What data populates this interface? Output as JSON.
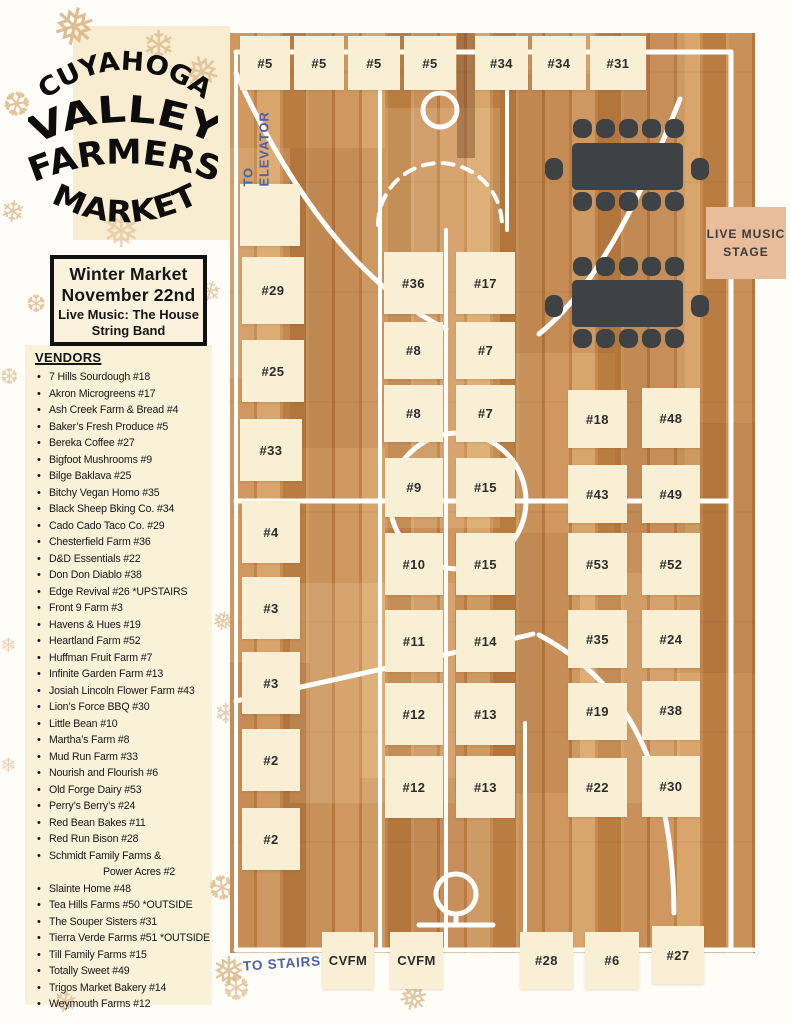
{
  "sidebar": {
    "logo": {
      "lines": [
        "CUYAHOGA",
        "VALLEY",
        "FARMERS",
        "MARKET"
      ]
    },
    "event_box": {
      "line1": "Winter Market",
      "line2": "November 22nd",
      "line3": "Live Music: The House String Band"
    },
    "vendors_heading": "VENDORS",
    "vendors": [
      {
        "text": "7 Hills Sourdough #18"
      },
      {
        "text": "Akron Microgreens #17"
      },
      {
        "text": "Ash Creek Farm & Bread #4"
      },
      {
        "text": "Baker’s Fresh Produce  #5"
      },
      {
        "text": "Bereka Coffee #27"
      },
      {
        "text": "Bigfoot Mushrooms  #9"
      },
      {
        "text": "Bilge Baklava #25"
      },
      {
        "text": "Bitchy Vegan Homo #35"
      },
      {
        "text": "Black Sheep Bking Co. #34"
      },
      {
        "text": "Cado Cado Taco Co. #29"
      },
      {
        "text": "Chesterfield Farm #36"
      },
      {
        "text": "D&D Essentials #22"
      },
      {
        "text": "Don Don Diablo #38"
      },
      {
        "text": "Edge Revival #26 *UPSTAIRS"
      },
      {
        "text": "Front 9 Farm #3"
      },
      {
        "text": "Havens & Hues #19"
      },
      {
        "text": "Heartland Farm #52"
      },
      {
        "text": "Huffman Fruit Farm #7"
      },
      {
        "text": "Infinite Garden Farm #13"
      },
      {
        "text": "Josiah Lincoln Flower Farm #43"
      },
      {
        "text": "Lion’s Force BBQ #30"
      },
      {
        "text": "Little Bean #10"
      },
      {
        "text": "Martha’s Farm  #8"
      },
      {
        "text": "Mud Run Farm #33"
      },
      {
        "text": "Nourish and Flourish  #6"
      },
      {
        "text": "Old Forge Dairy #53"
      },
      {
        "text": "Perry’s Berry’s  #24"
      },
      {
        "text": "Red Bean Bakes  #11"
      },
      {
        "text": "Red Run Bison #28"
      },
      {
        "text": "Schmidt Family Farms &"
      },
      {
        "text": "Power Acres #2",
        "indent": true
      },
      {
        "text": "Slainte Home #48"
      },
      {
        "text": "Tea Hills Farms #50 *OUTSIDE"
      },
      {
        "text": "The Souper Sisters #31"
      },
      {
        "text": "Tierra Verde Farms #51 *OUTSIDE"
      },
      {
        "text": "Till Family Farms #15"
      },
      {
        "text": "Totally Sweet #49"
      },
      {
        "text": "Trigos Market Bakery #14"
      },
      {
        "text": "Weymouth Farms #12"
      }
    ]
  },
  "map": {
    "to_elevator": "TO ELEVATOR",
    "to_stairs": "TO STAIRS",
    "stage": {
      "label": "LIVE MUSIC STAGE"
    },
    "booths": [
      {
        "label": "#5",
        "x": 240,
        "y": 36,
        "w": 50,
        "h": 54
      },
      {
        "label": "#5",
        "x": 294,
        "y": 36,
        "w": 50,
        "h": 54
      },
      {
        "label": "#5",
        "x": 348,
        "y": 36,
        "w": 52,
        "h": 54
      },
      {
        "label": "#5",
        "x": 404,
        "y": 36,
        "w": 52,
        "h": 54
      },
      {
        "label": "#34",
        "x": 475,
        "y": 36,
        "w": 53,
        "h": 54
      },
      {
        "label": "#34",
        "x": 532,
        "y": 36,
        "w": 54,
        "h": 54
      },
      {
        "label": "#31",
        "x": 590,
        "y": 36,
        "w": 56,
        "h": 54
      },
      {
        "label": "",
        "x": 240,
        "y": 184,
        "w": 60,
        "h": 62
      },
      {
        "label": "#29",
        "x": 242,
        "y": 257,
        "w": 62,
        "h": 67
      },
      {
        "label": "#25",
        "x": 242,
        "y": 340,
        "w": 62,
        "h": 62
      },
      {
        "label": "#33",
        "x": 240,
        "y": 419,
        "w": 62,
        "h": 62
      },
      {
        "label": "#4",
        "x": 242,
        "y": 501,
        "w": 58,
        "h": 62
      },
      {
        "label": "#3",
        "x": 242,
        "y": 577,
        "w": 58,
        "h": 62
      },
      {
        "label": "#3",
        "x": 242,
        "y": 652,
        "w": 58,
        "h": 62
      },
      {
        "label": "#2",
        "x": 242,
        "y": 729,
        "w": 58,
        "h": 62
      },
      {
        "label": "#2",
        "x": 242,
        "y": 808,
        "w": 58,
        "h": 62
      },
      {
        "label": "#36",
        "x": 384,
        "y": 252,
        "w": 59,
        "h": 62
      },
      {
        "label": "#17",
        "x": 456,
        "y": 252,
        "w": 59,
        "h": 62
      },
      {
        "label": "#8",
        "x": 384,
        "y": 322,
        "w": 59,
        "h": 57
      },
      {
        "label": "#7",
        "x": 456,
        "y": 322,
        "w": 59,
        "h": 57
      },
      {
        "label": "#8",
        "x": 384,
        "y": 385,
        "w": 59,
        "h": 57
      },
      {
        "label": "#7",
        "x": 456,
        "y": 385,
        "w": 59,
        "h": 57
      },
      {
        "label": "#9",
        "x": 385,
        "y": 458,
        "w": 58,
        "h": 59
      },
      {
        "label": "#15",
        "x": 456,
        "y": 458,
        "w": 59,
        "h": 59
      },
      {
        "label": "#10",
        "x": 385,
        "y": 533,
        "w": 58,
        "h": 62
      },
      {
        "label": "#15",
        "x": 456,
        "y": 533,
        "w": 59,
        "h": 62
      },
      {
        "label": "#11",
        "x": 385,
        "y": 610,
        "w": 58,
        "h": 62
      },
      {
        "label": "#14",
        "x": 456,
        "y": 610,
        "w": 59,
        "h": 62
      },
      {
        "label": "#12",
        "x": 385,
        "y": 683,
        "w": 58,
        "h": 62
      },
      {
        "label": "#13",
        "x": 456,
        "y": 683,
        "w": 59,
        "h": 62
      },
      {
        "label": "#12",
        "x": 385,
        "y": 756,
        "w": 58,
        "h": 62
      },
      {
        "label": "#13",
        "x": 456,
        "y": 756,
        "w": 59,
        "h": 62
      },
      {
        "label": "#18",
        "x": 568,
        "y": 390,
        "w": 59,
        "h": 58
      },
      {
        "label": "#48",
        "x": 642,
        "y": 388,
        "w": 58,
        "h": 60
      },
      {
        "label": "#43",
        "x": 568,
        "y": 465,
        "w": 59,
        "h": 58
      },
      {
        "label": "#49",
        "x": 642,
        "y": 465,
        "w": 58,
        "h": 58
      },
      {
        "label": "#53",
        "x": 568,
        "y": 533,
        "w": 59,
        "h": 62
      },
      {
        "label": "#52",
        "x": 642,
        "y": 533,
        "w": 58,
        "h": 62
      },
      {
        "label": "#35",
        "x": 568,
        "y": 610,
        "w": 59,
        "h": 58
      },
      {
        "label": "#24",
        "x": 642,
        "y": 610,
        "w": 58,
        "h": 58
      },
      {
        "label": "#19",
        "x": 568,
        "y": 683,
        "w": 59,
        "h": 57
      },
      {
        "label": "#38",
        "x": 642,
        "y": 681,
        "w": 58,
        "h": 59
      },
      {
        "label": "#22",
        "x": 568,
        "y": 758,
        "w": 59,
        "h": 59
      },
      {
        "label": "#30",
        "x": 642,
        "y": 756,
        "w": 58,
        "h": 61
      },
      {
        "label": "CVFM",
        "x": 322,
        "y": 932,
        "w": 52,
        "h": 57
      },
      {
        "label": "CVFM",
        "x": 390,
        "y": 932,
        "w": 53,
        "h": 57
      },
      {
        "label": "#28",
        "x": 520,
        "y": 932,
        "w": 53,
        "h": 57
      },
      {
        "label": "#6",
        "x": 585,
        "y": 932,
        "w": 54,
        "h": 57
      },
      {
        "label": "#27",
        "x": 652,
        "y": 926,
        "w": 52,
        "h": 58
      }
    ]
  },
  "decor": {
    "snowflakes": [
      {
        "g": "❅",
        "x": 52,
        "y": 2,
        "s": 52,
        "o": 0.95,
        "r": 12
      },
      {
        "g": "❄",
        "x": 142,
        "y": 26,
        "s": 40,
        "o": 0.8,
        "r": 0
      },
      {
        "g": "❆",
        "x": 2,
        "y": 88,
        "s": 34,
        "o": 0.85,
        "r": 20
      },
      {
        "g": "❅",
        "x": 184,
        "y": 52,
        "s": 44,
        "o": 0.75,
        "r": -14
      },
      {
        "g": "❄",
        "x": 0,
        "y": 198,
        "s": 30,
        "o": 0.8,
        "r": 8
      },
      {
        "g": "❅",
        "x": 102,
        "y": 208,
        "s": 46,
        "o": 0.55,
        "r": 0
      },
      {
        "g": "❆",
        "x": 26,
        "y": 293,
        "s": 24,
        "o": 0.8,
        "r": 0
      },
      {
        "g": "❄",
        "x": 198,
        "y": 278,
        "s": 28,
        "o": 0.7,
        "r": 16
      },
      {
        "g": "❆",
        "x": 0,
        "y": 366,
        "s": 22,
        "o": 0.7,
        "r": 0
      },
      {
        "g": "❅",
        "x": 212,
        "y": 608,
        "s": 26,
        "o": 0.75,
        "r": 10
      },
      {
        "g": "❄",
        "x": 214,
        "y": 700,
        "s": 28,
        "o": 0.7,
        "r": 0
      },
      {
        "g": "❆",
        "x": 208,
        "y": 872,
        "s": 34,
        "o": 0.8,
        "r": -10
      },
      {
        "g": "❅",
        "x": 212,
        "y": 952,
        "s": 40,
        "o": 0.85,
        "r": 0
      },
      {
        "g": "❄",
        "x": 52,
        "y": 988,
        "s": 30,
        "o": 0.75,
        "r": 12
      },
      {
        "g": "❆",
        "x": 222,
        "y": 972,
        "s": 34,
        "o": 0.7,
        "r": 0
      },
      {
        "g": "❅",
        "x": 398,
        "y": 980,
        "s": 36,
        "o": 0.8,
        "r": 18
      },
      {
        "g": "❄",
        "x": 0,
        "y": 636,
        "s": 20,
        "o": 0.6,
        "r": 0
      },
      {
        "g": "❄",
        "x": 0,
        "y": 756,
        "s": 20,
        "o": 0.6,
        "r": 0
      }
    ]
  },
  "colors": {
    "page_bg": "#fefdf8",
    "sidebar_cream": "#faf1d9",
    "booth_cream": "#f9efd4",
    "wood_mid": "#c9915a",
    "line_white": "#ffffff",
    "accent_blue": "#4d61a4",
    "stage_tan": "#e9bd9c",
    "table_dark": "#3e4245",
    "snowflake_tan": "#dcba8d",
    "text_black": "#161616"
  }
}
